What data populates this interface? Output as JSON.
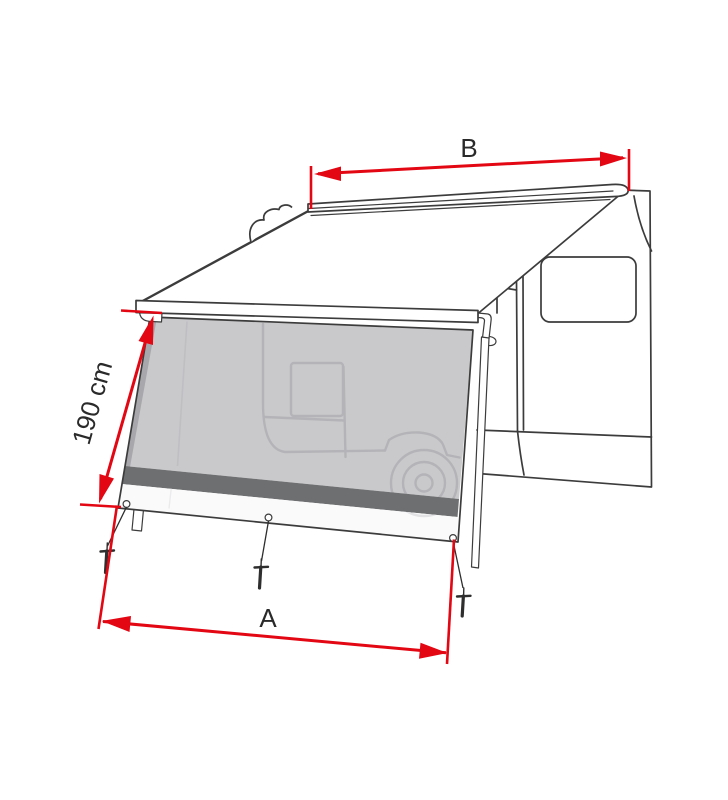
{
  "diagram": {
    "type": "technical-line-illustration",
    "subject": "camper-van awning with front sun-block side panel and dimension arrows",
    "dimension_labels": {
      "top_width": "B",
      "side_height": "190 cm",
      "bottom_width": "A"
    },
    "colors": {
      "dimension_arrows": "#e30613",
      "label_text": "#2a2a2a",
      "outline": "#3c3c3c",
      "mesh_panel": "#c9c9cb",
      "mesh_edge_fold": "#a8a8ac",
      "silhouette": "#b4b4b8",
      "panel_band": "#6e6f71",
      "panel_skirt": "#fafafa",
      "background": "#ffffff"
    }
  }
}
